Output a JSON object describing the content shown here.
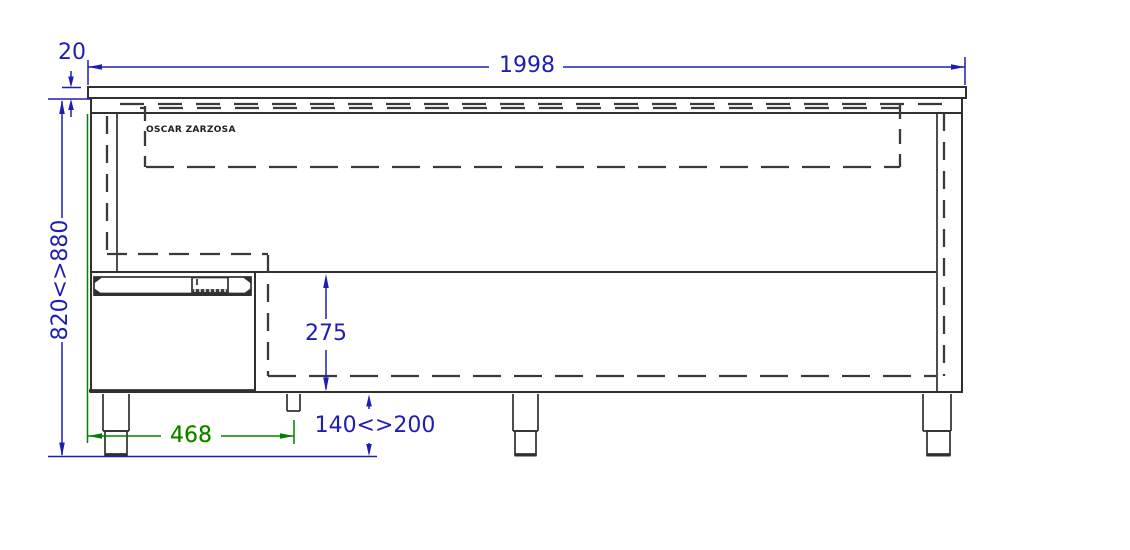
{
  "brand": {
    "label": "OSCAR ZARZOSA"
  },
  "dims": {
    "total_width": "1998",
    "top_thickness": "20",
    "height_range": "820<>880",
    "drawer_front_height": "275",
    "leg_height_range": "140<>200",
    "drawer_module_width": "468"
  },
  "colors": {
    "dimension_blue": "#1e1eb4",
    "dimension_green": "#008000",
    "drawing_lines": "#303030",
    "hidden_lines": "#3a3a3a"
  }
}
